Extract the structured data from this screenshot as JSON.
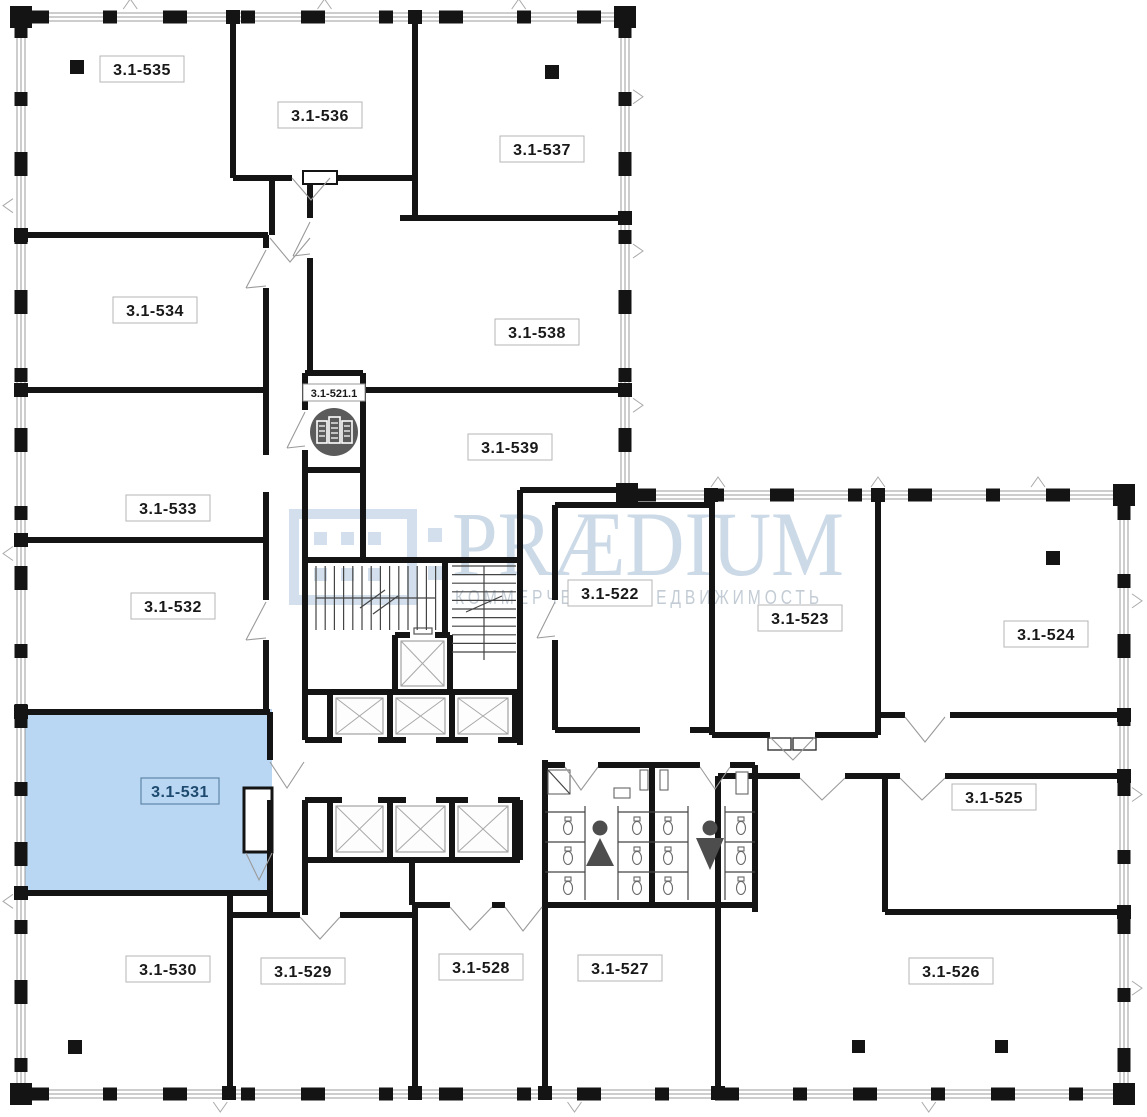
{
  "floor_plan": {
    "rooms": [
      {
        "label": "3.1-535"
      },
      {
        "label": "3.1-536"
      },
      {
        "label": "3.1-537"
      },
      {
        "label": "3.1-534"
      },
      {
        "label": "3.1-538"
      },
      {
        "label": "3.1-533"
      },
      {
        "label": "3.1-539"
      },
      {
        "label": "3.1-532"
      },
      {
        "label": "3.1-531",
        "highlighted": true,
        "fill": "#b9d6f3",
        "label_color": "#1d4a6e"
      },
      {
        "label": "3.1-530"
      },
      {
        "label": "3.1-529"
      },
      {
        "label": "3.1-528"
      },
      {
        "label": "3.1-527"
      },
      {
        "label": "3.1-526"
      },
      {
        "label": "3.1-522"
      },
      {
        "label": "3.1-523"
      },
      {
        "label": "3.1-524"
      },
      {
        "label": "3.1-525"
      }
    ],
    "unit_badge": {
      "label": "3.1-521.1"
    },
    "highlight": {
      "room": "3.1-531",
      "fill": "#b9d6f3"
    },
    "watermark": {
      "title": "PRÆDIUM",
      "subtitle": "КОММЕРЧЕСКАЯ НЕДВИЖИМОСТЬ",
      "title_color": "#ccd9e7",
      "subtitle_color": "#c3ccd5",
      "logo_color": "#d3dfec"
    },
    "icons": {
      "women": "women-restroom-icon",
      "men": "men-restroom-icon",
      "building": "building-location-icon"
    },
    "colors": {
      "wall": "#141414",
      "window_band": "#9b9b9b",
      "door_swing": "#9a9a9a",
      "highlight_fill": "#b9d6f3",
      "highlight_border": "#5e86a8",
      "restroom_icon": "#4d4d4d",
      "badge_circle": "#5b5b5b"
    }
  }
}
